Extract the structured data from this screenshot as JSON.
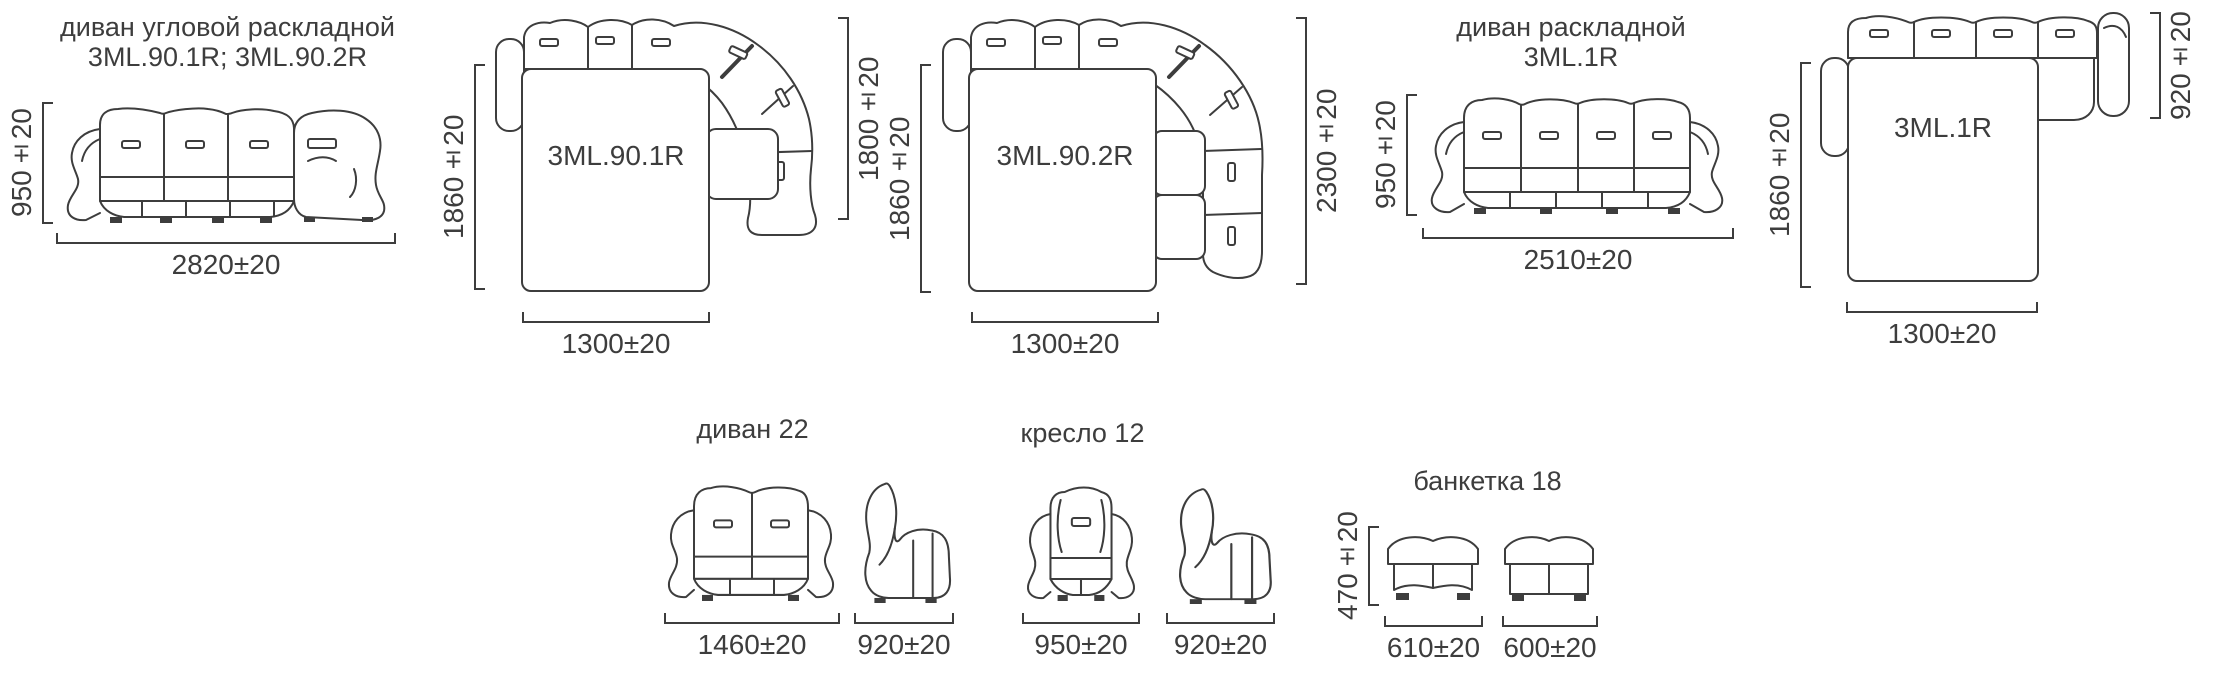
{
  "colors": {
    "line": "#3d3d3d",
    "text": "#3d3d3d",
    "background": "#ffffff"
  },
  "sections": {
    "corner_sofa": {
      "title_line1": "диван угловой раскладной",
      "title_line2": "3ML.90.1R; 3ML.90.2R",
      "front_height": "950±20",
      "front_width": "2820±20",
      "plan1": {
        "label": "3ML.90.1R",
        "left": "1860±20",
        "right": "1800±20",
        "bottom": "1300±20"
      },
      "plan2": {
        "label": "3ML.90.2R",
        "left": "1860±20",
        "right": "2300±20",
        "bottom": "1300±20"
      }
    },
    "folding_sofa": {
      "title_line1": "диван раскладной",
      "title_line2": "3ML.1R",
      "front_height": "950±20",
      "front_width": "2510±20",
      "plan": {
        "label": "3ML.1R",
        "left": "1860±20",
        "right": "920±20",
        "bottom": "1300±20"
      }
    },
    "sofa22": {
      "title": "диван 22",
      "front_width": "1460±20",
      "side_width": "920±20"
    },
    "armchair12": {
      "title": "кресло 12",
      "front_width": "950±20",
      "side_width": "920±20"
    },
    "bench18": {
      "title": "банкетка 18",
      "height": "470±20",
      "front_width": "610±20",
      "side_width": "600±20"
    }
  }
}
